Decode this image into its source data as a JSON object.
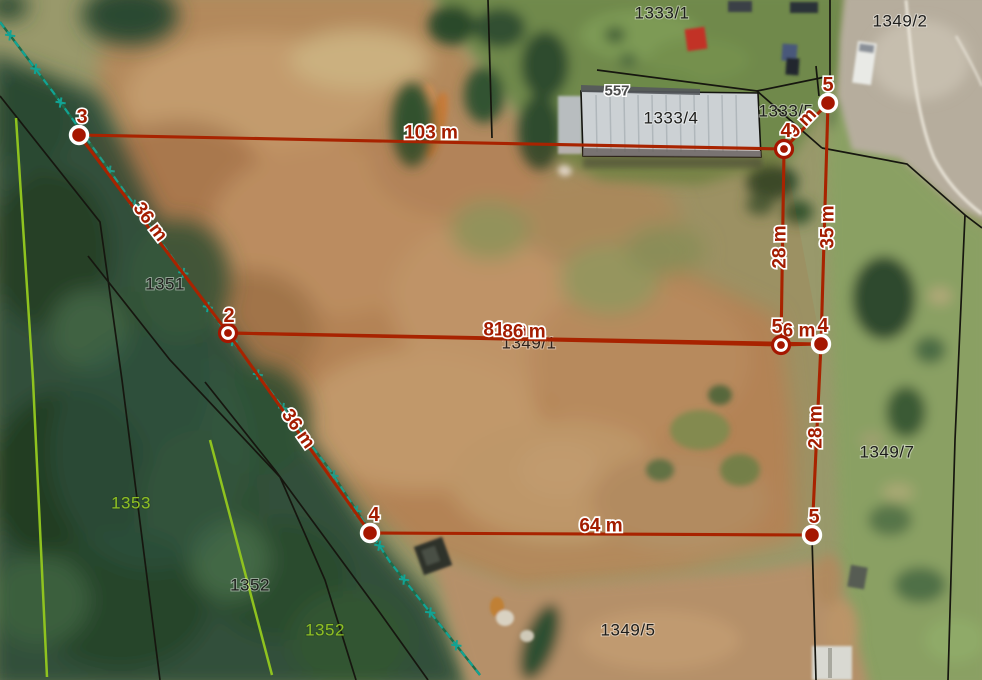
{
  "map": {
    "colors": {
      "measure_line": "#a82300",
      "measure_fill": "#a51600",
      "measure_text": "#a31c00",
      "parcel_text": "#1d1d1b",
      "parcel_text_green": "#8fbf23",
      "building_text": "#4c4c4c",
      "boundary_black": "#16160f",
      "boundary_lime": "#8fc31f",
      "survey_teal": "#12a393",
      "survey_base_green": "#1d6b4a"
    },
    "parcel_labels": [
      {
        "text": "1333/1",
        "x": 662,
        "y": 13,
        "type": "black"
      },
      {
        "text": "1349/2",
        "x": 900,
        "y": 21,
        "type": "black"
      },
      {
        "text": "557",
        "x": 617,
        "y": 91,
        "type": "building"
      },
      {
        "text": "1333/4",
        "x": 671,
        "y": 118,
        "type": "black"
      },
      {
        "text": "1333/5",
        "x": 786,
        "y": 111,
        "type": "black"
      },
      {
        "text": "1351",
        "x": 165,
        "y": 284,
        "type": "black"
      },
      {
        "text": "1349/1",
        "x": 529,
        "y": 343,
        "type": "black"
      },
      {
        "text": "1349/7",
        "x": 887,
        "y": 452,
        "type": "black"
      },
      {
        "text": "1353",
        "x": 131,
        "y": 503,
        "type": "green"
      },
      {
        "text": "1352",
        "x": 250,
        "y": 585,
        "type": "black"
      },
      {
        "text": "1352",
        "x": 325,
        "y": 630,
        "type": "green"
      },
      {
        "text": "1349/5",
        "x": 628,
        "y": 630,
        "type": "black"
      }
    ],
    "building_557": {
      "outline": [
        [
          581,
          91
        ],
        [
          758,
          93
        ],
        [
          761,
          157
        ],
        [
          583,
          156
        ]
      ]
    },
    "boundaries": [
      {
        "color": "black",
        "points": [
          [
            0,
            96
          ],
          [
            100,
            222
          ],
          [
            122,
            380
          ],
          [
            160,
            680
          ]
        ]
      },
      {
        "color": "black",
        "points": [
          [
            88,
            256
          ],
          [
            170,
            360
          ],
          [
            280,
            477
          ],
          [
            325,
            580
          ],
          [
            356,
            680
          ]
        ]
      },
      {
        "color": "black",
        "points": [
          [
            205,
            382
          ],
          [
            275,
            470
          ],
          [
            378,
            610
          ],
          [
            428,
            680
          ]
        ]
      },
      {
        "color": "black",
        "points": [
          [
            488,
            0
          ],
          [
            492,
            138
          ]
        ]
      },
      {
        "color": "black",
        "points": [
          [
            597,
            70
          ],
          [
            757,
            91
          ],
          [
            830,
            76
          ],
          [
            830,
            0
          ]
        ]
      },
      {
        "color": "black",
        "points": [
          [
            757,
            91
          ],
          [
            822,
            148
          ]
        ]
      },
      {
        "color": "black",
        "points": [
          [
            816,
            66
          ],
          [
            819,
            96
          ]
        ]
      },
      {
        "color": "black",
        "points": [
          [
            822,
            148
          ],
          [
            907,
            164
          ],
          [
            965,
            215
          ],
          [
            982,
            228
          ]
        ]
      },
      {
        "color": "black",
        "points": [
          [
            965,
            215
          ],
          [
            955,
            440
          ],
          [
            948,
            680
          ]
        ]
      },
      {
        "color": "black",
        "points": [
          [
            812,
            537
          ],
          [
            816,
            680
          ]
        ]
      },
      {
        "color": "lime",
        "points": [
          [
            16,
            118
          ],
          [
            33,
            380
          ],
          [
            47,
            677
          ]
        ]
      },
      {
        "color": "lime",
        "points": [
          [
            210,
            440
          ],
          [
            272,
            675
          ]
        ]
      }
    ],
    "survey_line": {
      "points": [
        [
          0,
          22
        ],
        [
          53,
          92
        ],
        [
          187,
          278
        ],
        [
          228,
          335
        ],
        [
          330,
          470
        ],
        [
          390,
          562
        ],
        [
          480,
          675
        ]
      ],
      "marker_spacing": 42
    },
    "measurement": {
      "area_tint": [
        [
          79,
          135
        ],
        [
          784,
          149
        ],
        [
          821,
          344
        ],
        [
          812,
          535
        ],
        [
          370,
          533
        ],
        [
          228,
          333
        ]
      ],
      "segments": [
        {
          "from": [
            79,
            135
          ],
          "to": [
            784,
            149
          ],
          "label": "103 m",
          "lx": 431,
          "ly": 133,
          "rot": 0
        },
        {
          "from": [
            228,
            333
          ],
          "to": [
            79,
            135
          ],
          "label": "36 m",
          "lx": 150,
          "ly": 222,
          "rot": 53
        },
        {
          "from": [
            781,
            345
          ],
          "to": [
            228,
            333
          ],
          "label": "81 m",
          "lx": 505,
          "ly": 330,
          "rot": 0
        },
        {
          "from": [
            228,
            333
          ],
          "to": [
            821,
            344
          ],
          "label": "86 m",
          "lx": 524,
          "ly": 332,
          "rot": 0
        },
        {
          "from": [
            784,
            149
          ],
          "to": [
            828,
            103
          ],
          "label": "9 m",
          "lx": 802,
          "ly": 123,
          "rot": -46
        },
        {
          "from": [
            784,
            149
          ],
          "to": [
            781,
            345
          ],
          "label": "28 m",
          "lx": 780,
          "ly": 247,
          "rot": -90
        },
        {
          "from": [
            828,
            103
          ],
          "to": [
            821,
            344
          ],
          "label": "35 m",
          "lx": 828,
          "ly": 227,
          "rot": -90
        },
        {
          "from": [
            781,
            345
          ],
          "to": [
            821,
            344
          ],
          "label": "6 m",
          "lx": 799,
          "ly": 331,
          "rot": 0
        },
        {
          "from": [
            821,
            344
          ],
          "to": [
            812,
            535
          ],
          "label": "28 m",
          "lx": 816,
          "ly": 427,
          "rot": -90
        },
        {
          "from": [
            812,
            535
          ],
          "to": [
            370,
            533
          ],
          "label": "64 m",
          "lx": 601,
          "ly": 526,
          "rot": 0
        },
        {
          "from": [
            370,
            533
          ],
          "to": [
            228,
            333
          ],
          "label": "36 m",
          "lx": 298,
          "ly": 429,
          "rot": 55
        }
      ],
      "vertices": [
        {
          "label": "3",
          "x": 79,
          "y": 135,
          "style": "solid",
          "lx": 82,
          "ly": 117
        },
        {
          "label": "2",
          "x": 228,
          "y": 333,
          "style": "donut",
          "lx": 229,
          "ly": 316
        },
        {
          "label": "4",
          "x": 784,
          "y": 149,
          "style": "donut",
          "lx": 786,
          "ly": 131
        },
        {
          "label": "5",
          "x": 828,
          "y": 103,
          "style": "solid",
          "lx": 828,
          "ly": 85
        },
        {
          "label": "5",
          "x": 781,
          "y": 345,
          "style": "donut",
          "lx": 777,
          "ly": 327
        },
        {
          "label": "4",
          "x": 821,
          "y": 344,
          "style": "solid",
          "lx": 823,
          "ly": 326
        },
        {
          "label": "4",
          "x": 370,
          "y": 533,
          "style": "solid",
          "lx": 374,
          "ly": 515
        },
        {
          "label": "5",
          "x": 812,
          "y": 535,
          "style": "solid",
          "lx": 814,
          "ly": 517
        }
      ]
    }
  }
}
